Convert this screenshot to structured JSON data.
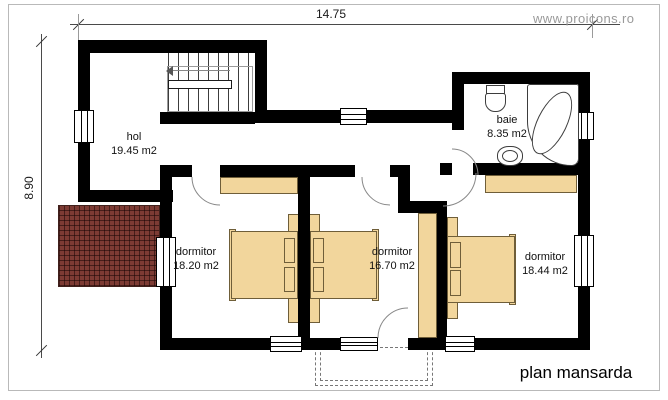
{
  "sheet": {
    "watermark": "www.proicons.ro",
    "plan_title": "plan mansarda"
  },
  "dimensions": {
    "width_total": "14.75",
    "height_total": "8.90"
  },
  "rooms": [
    {
      "name": "hol",
      "area": "19.45 m2"
    },
    {
      "name": "baie",
      "area": "8.35 m2"
    },
    {
      "name": "dormitor",
      "area": "18.20 m2"
    },
    {
      "name": "dormitor",
      "area": "16.70 m2"
    },
    {
      "name": "dormitor",
      "area": "18.44 m2"
    }
  ],
  "colors": {
    "wall": "#000000",
    "furniture": "#f2d69c",
    "roof_hatch": "#7d3b34",
    "watermark": "#9a9a9a"
  }
}
